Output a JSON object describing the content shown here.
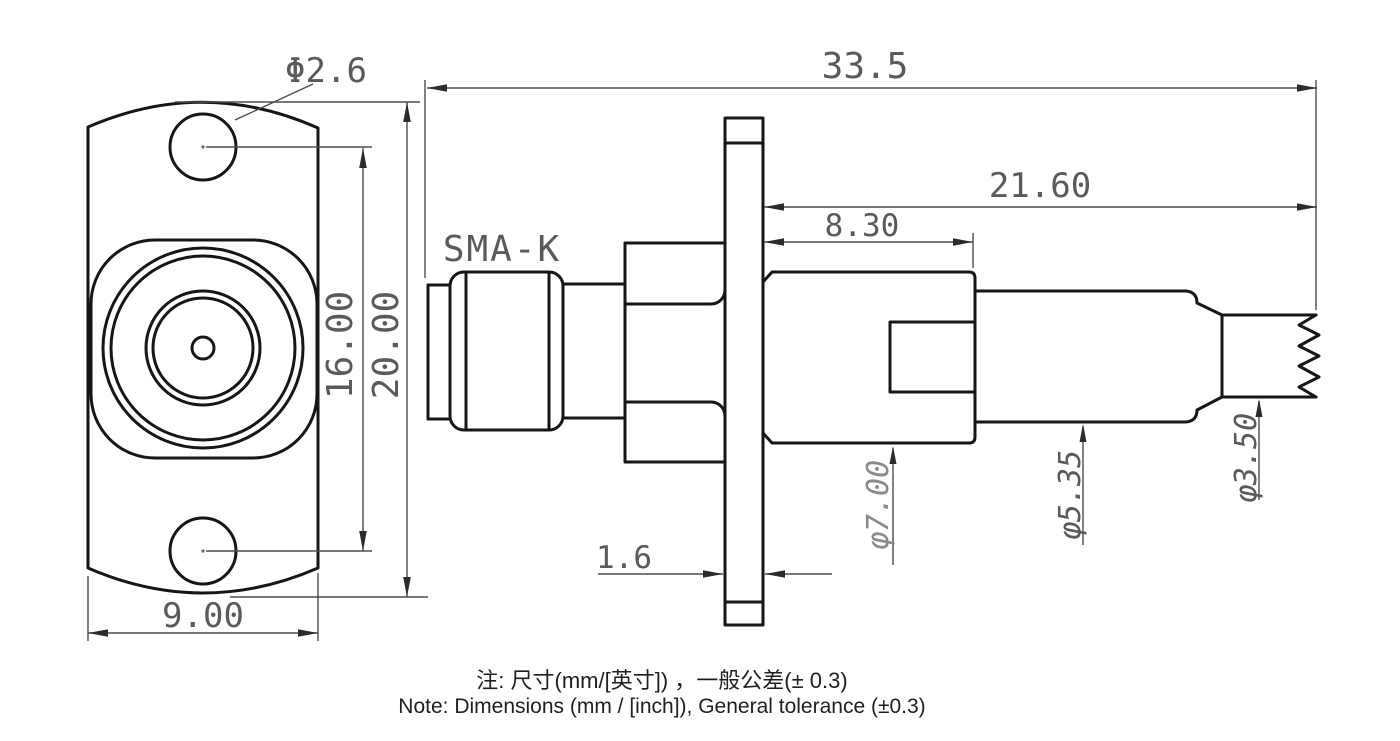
{
  "drawing": {
    "part_label": "SMA-K",
    "dims": {
      "hole_dia": "Φ2.6",
      "overall_len": "33.5",
      "rear_len": "21.60",
      "body_len": "8.30",
      "hole_spacing": "16.00",
      "flange_h": "20.00",
      "flange_w": "9.00",
      "flange_t": "1.6",
      "body_dia": "φ7.00",
      "cyl_dia": "φ5.35",
      "cable_dia": "φ3.50"
    },
    "note_zh": "注: 尺寸(mm/[英寸]) ，一般公差(± 0.3)",
    "note_en": "Note: Dimensions (mm / [inch]), General tolerance (±0.3)",
    "colors": {
      "line": "#161616",
      "dim_line": "#4d4d4d",
      "text": "#5a5a5a",
      "text_light": "#8a8a8a",
      "note": "#1f1f1f"
    }
  }
}
